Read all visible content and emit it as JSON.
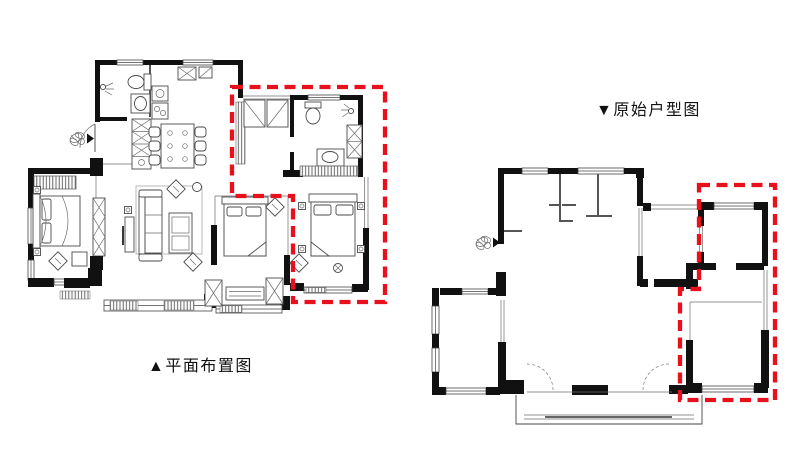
{
  "canvas": {
    "width": 800,
    "height": 449,
    "background": "#ffffff"
  },
  "colors": {
    "walls": "#111111",
    "lines": "#444444",
    "highlight_red": "#e8101c"
  },
  "plans": {
    "left": {
      "label": "▲平面布置图",
      "kind": "furnished layout plan",
      "highlight": "red dashed outline around right-side bath + bedroom zone"
    },
    "right": {
      "label": "▼原始户型图",
      "kind": "original unfurnished plan",
      "highlight": "red dashed outline around right-side room zone"
    }
  },
  "icons": {
    "entry_plant": {
      "name": "entry-plant-icon",
      "shape": "potted plant sketch with solid entry arrow ▶"
    },
    "triangle_up": "▲",
    "triangle_down": "▼"
  }
}
